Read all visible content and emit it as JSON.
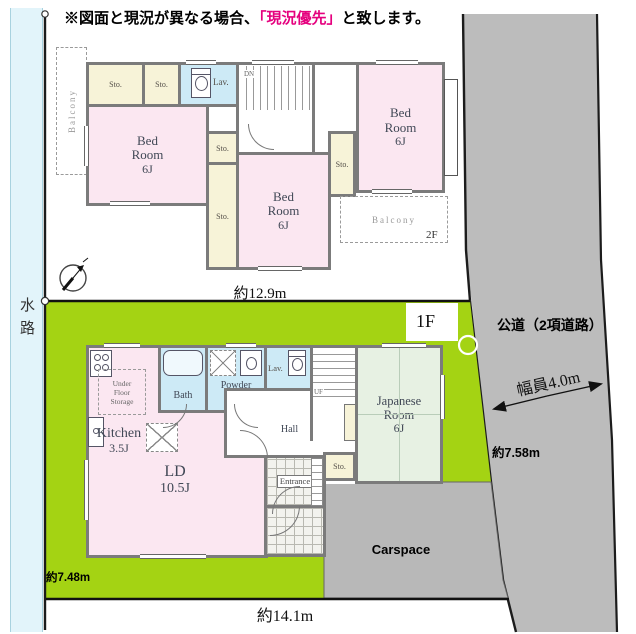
{
  "disclaimer": {
    "pre": "※図面と現況が異なる場合、",
    "em": "「現況優先」",
    "post": "と致します。"
  },
  "site": {
    "waterway": "水路",
    "road_label": "公道（2項道路）",
    "road_width": "幅員4.0m",
    "carspace": "Carspace",
    "dim_top": "約12.9m",
    "dim_bottom": "約14.1m",
    "dim_left": "約7.48m",
    "dim_right": "約7.58m"
  },
  "f2": {
    "label": "2F",
    "balcony": "Balcony",
    "stairs": "DN",
    "lav": "Lav.",
    "sto": "Sto.",
    "bed_l1": "Bed",
    "bed_l2": "Room",
    "bed_size": "6J"
  },
  "f1": {
    "label": "1F",
    "kitchen": "Kitchen",
    "kitchen_size": "3.5J",
    "ufs_l1": "Under",
    "ufs_l2": "Floor",
    "ufs_l3": "Storage",
    "ld": "LD",
    "ld_size": "10.5J",
    "bath": "Bath",
    "powder_l1": "Powder",
    "powder_l2": "Room",
    "lav": "Lav.",
    "hall": "Hall",
    "stairs": "UF",
    "jp_l1": "Japanese",
    "jp_l2": "Room",
    "jp_size": "6J",
    "sto": "Sto.",
    "entrance": "Entrance"
  },
  "colors": {
    "lot_green": "#a4d313",
    "road_gray": "#bcbcbc",
    "carspace_gray": "#b8b8b8",
    "room_pink": "#fbe7f1",
    "storage_cream": "#f7f3d8",
    "wet_blue": "#cdeaf6",
    "tatami_green": "#e7f1e3",
    "wall_gray": "#7b7b7b",
    "highlight_magenta": "#e5007e",
    "waterway_blue": "#e2f4fa"
  }
}
